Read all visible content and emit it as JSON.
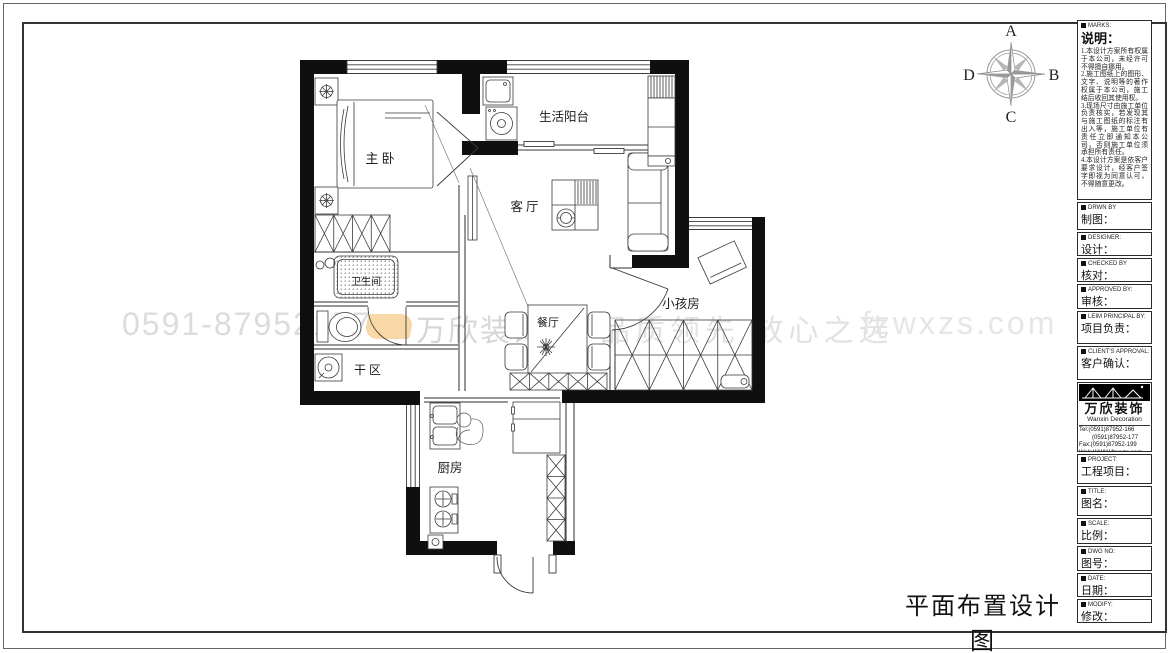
{
  "page": {
    "drawing_title": "平面布置设计图"
  },
  "colors": {
    "wall": "#0f0f0f",
    "line": "#3a3a3a",
    "watermark_gray": "#dcdcdc",
    "brand_orange": "#f2a83c"
  },
  "compass": {
    "north": "A",
    "east": "B",
    "south": "C",
    "west": "D"
  },
  "floorplan": {
    "rooms": [
      {
        "id": "master-bedroom",
        "label": "主 卧"
      },
      {
        "id": "life-balcony",
        "label": "生活阳台"
      },
      {
        "id": "living-room",
        "label": "客厅"
      },
      {
        "id": "bathroom",
        "label": "卫生间"
      },
      {
        "id": "dining-room",
        "label": "餐厅"
      },
      {
        "id": "kids-room",
        "label": "小孩房"
      },
      {
        "id": "dry-area",
        "label": "干区"
      },
      {
        "id": "kitchen",
        "label": "厨房"
      }
    ]
  },
  "watermark": {
    "phone": "0591-87952177",
    "brand": "万欣装饰",
    "slogan": "品质领先 放心之选",
    "site": "fzwxzs.com"
  },
  "title_block": {
    "notes": {
      "caption": "MARKS:",
      "title": "说明：",
      "items": [
        "1.本设计方案所有权属于本公司，未经许可不得擅自挪用。",
        "2.施工图纸上的图形、文字、说明等的著作权属于本公司，施工结后收回其使用权。",
        "3.现场尺寸由施工单位负责核实，若发现其与施工图纸的标注有出入等，施工单位有责任立即通知本公司，否则施工单位须承担所有责任。",
        "4.本设计方案是依客户要求设计，经客户签字即视为同意认可，不得随意更改。"
      ]
    },
    "fields": [
      {
        "caption": "DRWN BY",
        "label": "制图："
      },
      {
        "caption": "DESIGNER:",
        "label": "设计："
      },
      {
        "caption": "CHECKED BY",
        "label": "核对："
      },
      {
        "caption": "APPROVED BY:",
        "label": "审核："
      },
      {
        "caption": "LEIM PRINCIPAL BY:",
        "label": "项目负责："
      },
      {
        "caption": "CLIENT'S APPROVAL:",
        "label": "客户确认："
      }
    ],
    "company": {
      "name": "万欣装饰",
      "name_en": "Wanxin Decoration",
      "tel1": "Tel:(0591)87952-166",
      "tel2": "(0591)87952-177",
      "fax": "Fax:(0591)87952-199",
      "web": "Web:WWW.fzwxzs.com"
    },
    "fields2": [
      {
        "caption": "PROJECT:",
        "label": "工程项目："
      },
      {
        "caption": "TITLE:",
        "label": "图名："
      },
      {
        "caption": "SCALE:",
        "label": "比例："
      },
      {
        "caption": "DWG NO:",
        "label": "图号："
      },
      {
        "caption": "DATE:",
        "label": "日期："
      },
      {
        "caption": "MODIFY:",
        "label": "修改："
      }
    ]
  }
}
